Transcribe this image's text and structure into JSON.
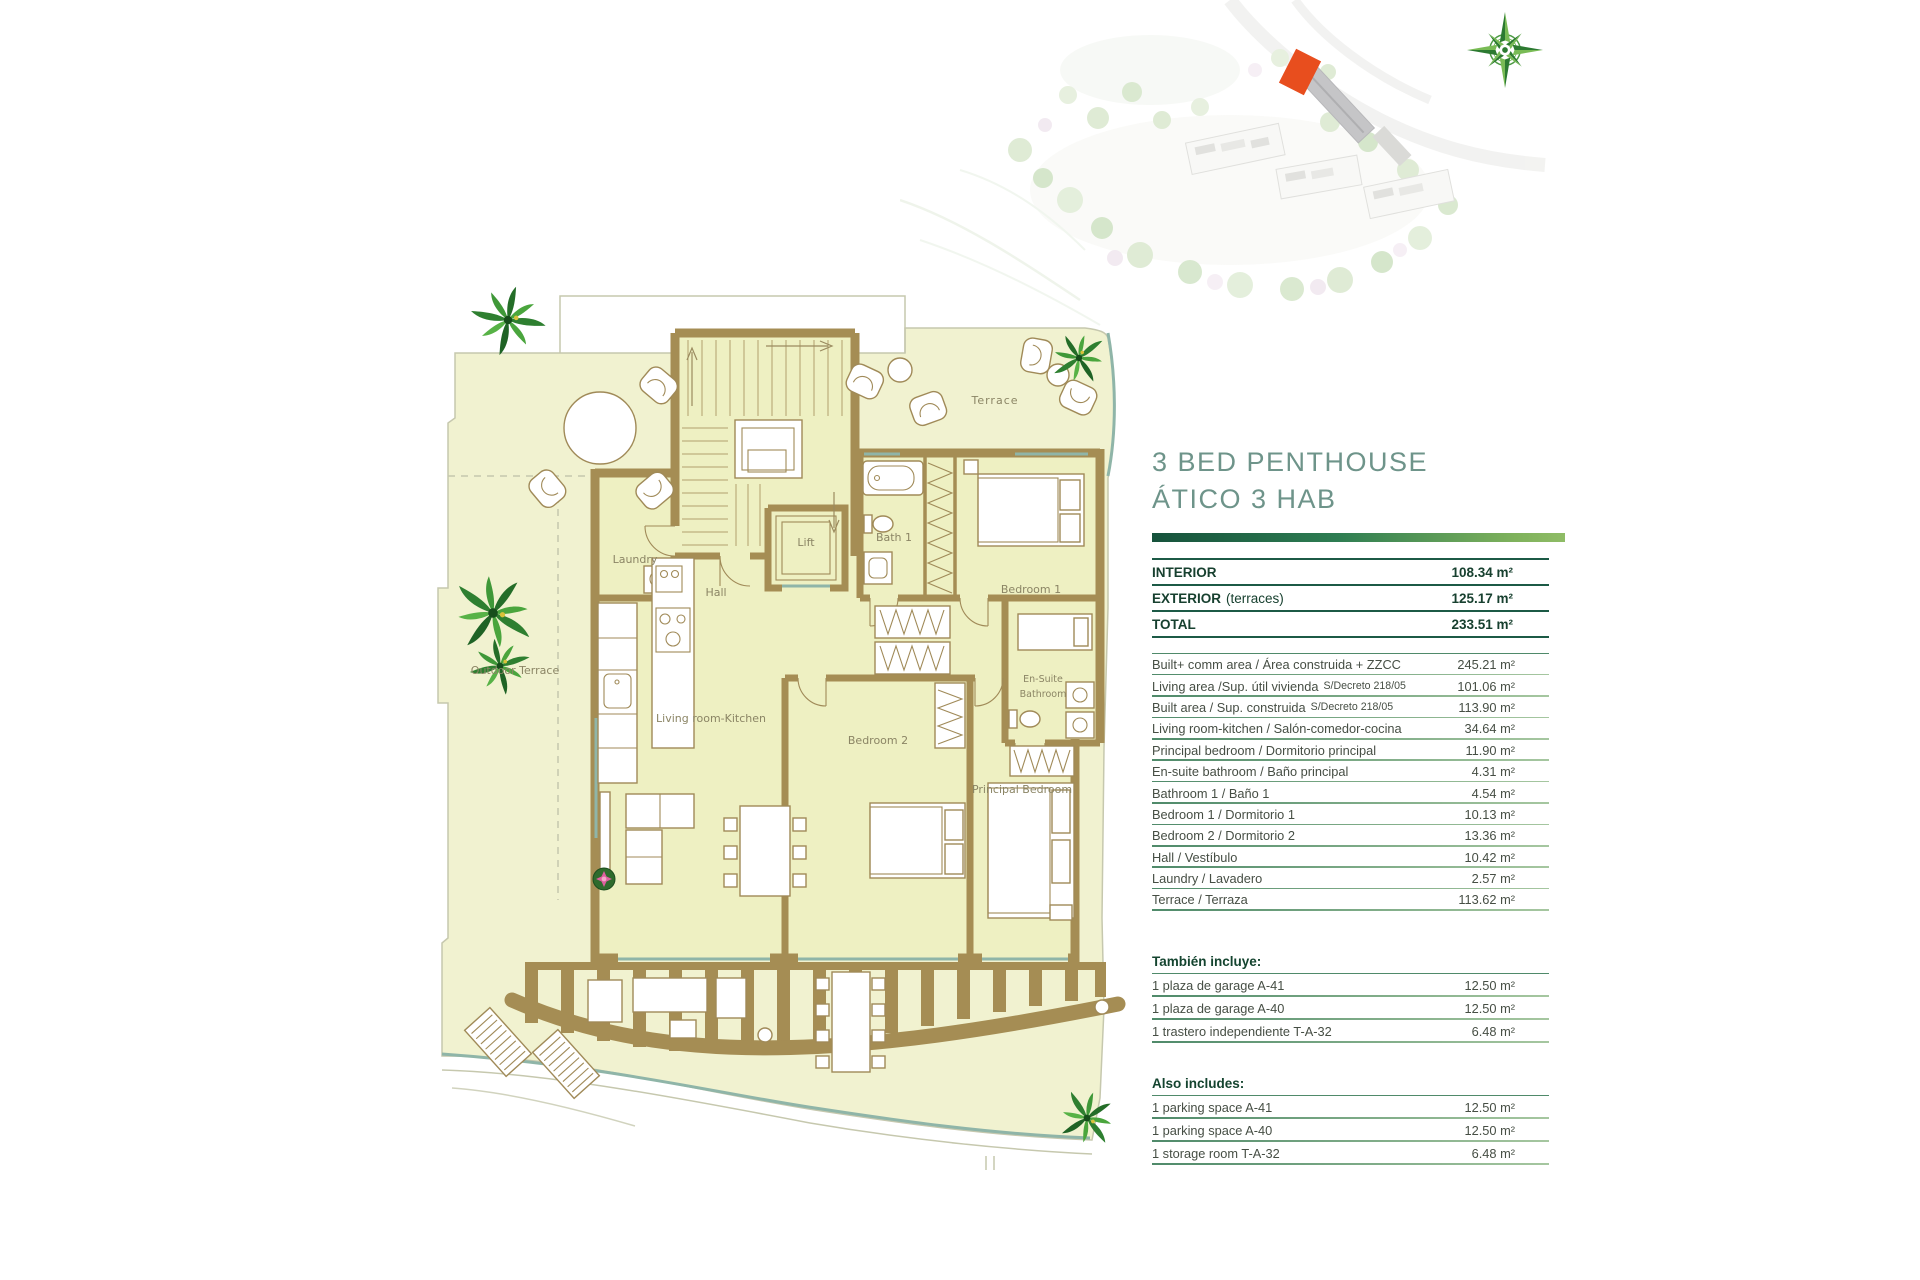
{
  "title": {
    "line1": "3 BED PENTHOUSE",
    "line2": "ÁTICO 3 HAB"
  },
  "summary": {
    "rows": [
      {
        "label": "INTERIOR",
        "note": "",
        "value": "108.34 m²"
      },
      {
        "label": "EXTERIOR",
        "note": "(terraces)",
        "value": "125.17 m²"
      },
      {
        "label": "TOTAL",
        "note": "",
        "value": "233.51 m²"
      }
    ]
  },
  "areas": {
    "rows": [
      {
        "label": "Built+ comm  area / Área construida + ZZCC",
        "small": "",
        "value": "245.21 m²"
      },
      {
        "label": "Living area /Sup. útil vivienda",
        "small": "S/Decreto 218/05",
        "value": "101.06 m²"
      },
      {
        "label": "Built area / Sup. construida",
        "small": "S/Decreto 218/05",
        "value": "113.90 m²"
      },
      {
        "label": "Living room-kitchen / Salón-comedor-cocina",
        "small": "",
        "value": "34.64 m²"
      },
      {
        "label": "Principal bedroom / Dormitorio principal",
        "small": "",
        "value": "11.90 m²"
      },
      {
        "label": "En-suite bathroom / Baño principal",
        "small": "",
        "value": "4.31 m²"
      },
      {
        "label": "Bathroom 1 / Baño 1",
        "small": "",
        "value": "4.54 m²"
      },
      {
        "label": "Bedroom 1 / Dormitorio 1",
        "small": "",
        "value": "10.13 m²"
      },
      {
        "label": "Bedroom 2 / Dormitorio 2",
        "small": "",
        "value": "13.36 m²"
      },
      {
        "label": "Hall / Vestíbulo",
        "small": "",
        "value": "10.42 m²"
      },
      {
        "label": "Laundry / Lavadero",
        "small": "",
        "value": "2.57 m²"
      },
      {
        "label": "Terrace / Terraza",
        "small": "",
        "value": "113.62 m²"
      }
    ]
  },
  "tambien": {
    "heading": "También incluye:",
    "rows": [
      {
        "label": "1 plaza de garage A-41",
        "value": "12.50 m²"
      },
      {
        "label": "1 plaza de garage A-40",
        "value": "12.50 m²"
      },
      {
        "label": "1 trastero independiente T-A-32",
        "value": "6.48 m²"
      }
    ]
  },
  "also": {
    "heading": "Also includes:",
    "rows": [
      {
        "label": "1 parking space A-41",
        "value": "12.50 m²"
      },
      {
        "label": "1 parking space A-40",
        "value": "12.50 m²"
      },
      {
        "label": "1 storage room T-A-32",
        "value": "6.48 m²"
      }
    ]
  },
  "floor_plan": {
    "rooms": {
      "terrace": "Terrace",
      "laundry": "Laundry",
      "hall": "Hall",
      "lift": "Lift",
      "bath1": "Bath 1",
      "bedroom1": "Bedroom 1",
      "ensuite1": "En-Suite",
      "ensuite2": "Bathroom",
      "bedroom2": "Bedroom 2",
      "principal": "Principal Bedroom",
      "living": "Living room-Kitchen",
      "outdoor": "Outdoor Terrace"
    }
  },
  "colors": {
    "accent_dark": "#1c5a45",
    "accent": "#2e7d52",
    "accent_light": "#8aba5e",
    "title_color": "#6e948a",
    "wall_brown": "#a58d54",
    "floor_yellow": "#eef0c2",
    "terrace_yellow": "#f1f2d0",
    "highlight_orange": "#e84e1e",
    "compass_green": "#2c7a31"
  }
}
